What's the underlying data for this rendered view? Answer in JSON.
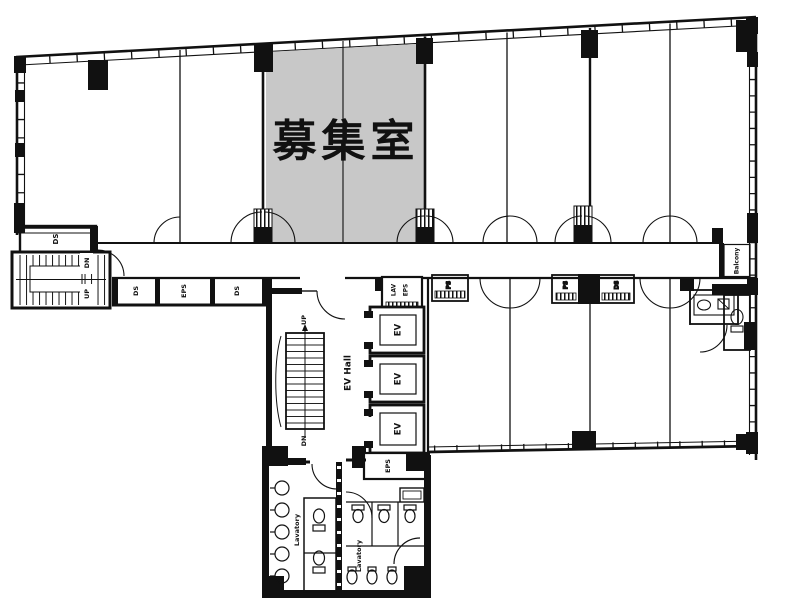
{
  "colors": {
    "wall": "#111111",
    "highlight": "#c8c8c8",
    "background": "#ffffff"
  },
  "labels": {
    "vacant_room": "募集室",
    "ds": "DS",
    "eps": "EPS",
    "ps": "PS",
    "lav": "LAV",
    "up": "UP",
    "dn": "DN",
    "ev": "EV",
    "ev_hall": "EV Hall",
    "balcony": "Balcony",
    "lavatory": "Lavatory"
  }
}
